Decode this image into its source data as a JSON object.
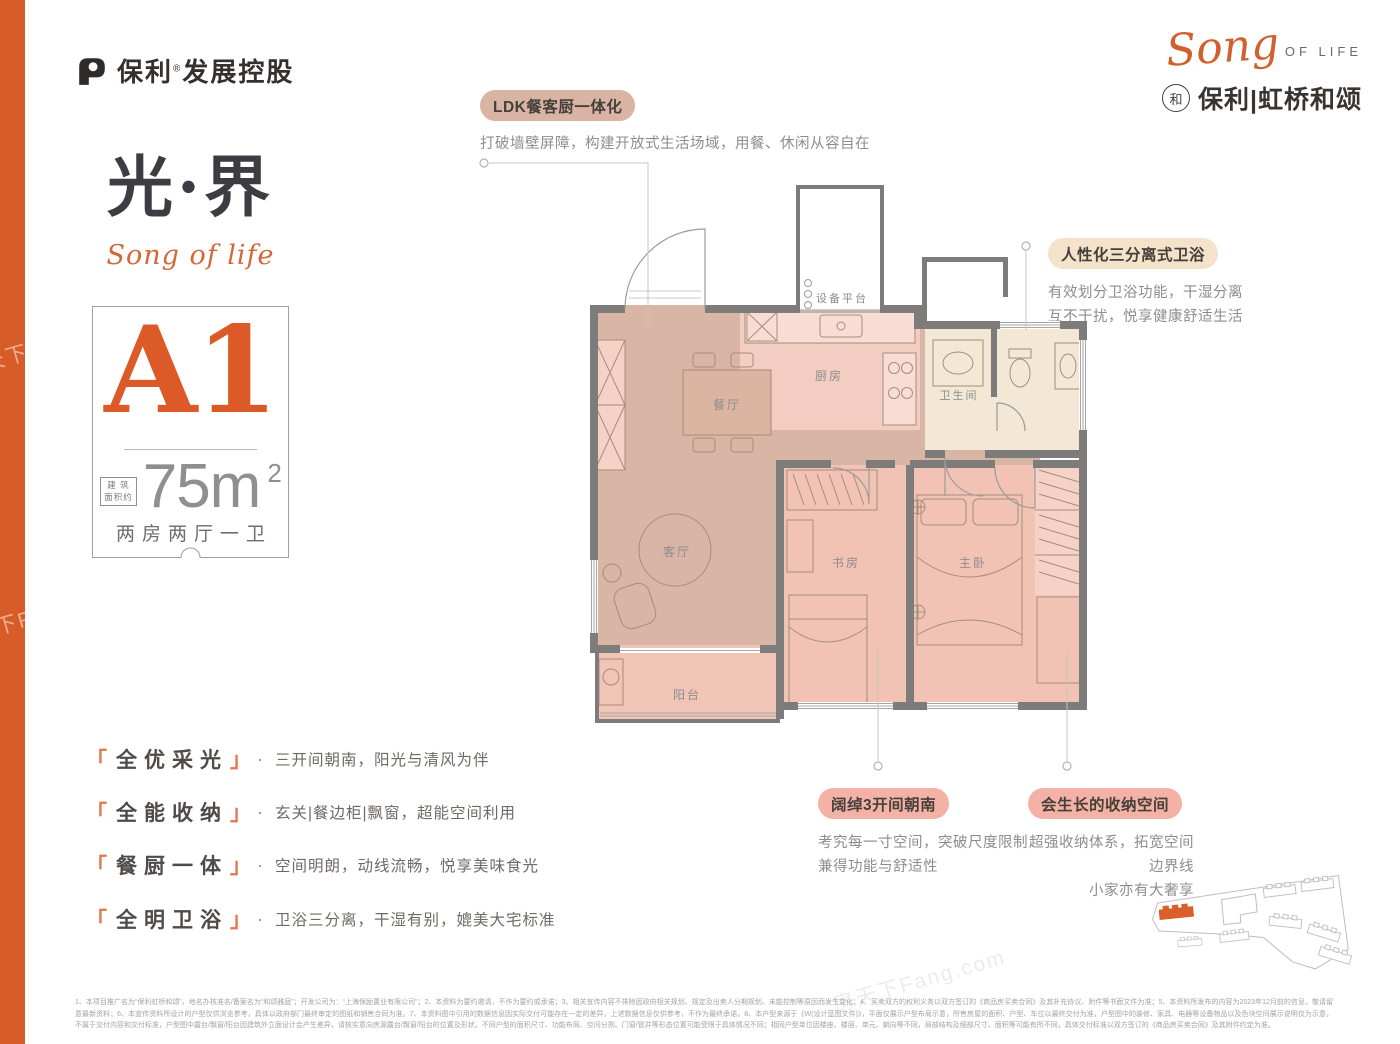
{
  "colors": {
    "accent_orange": "#d85c27",
    "unit_orange": "#dc5a28",
    "pill_ldk_bg": "#d9b4a4",
    "pill_bath_bg": "#f4e2ca",
    "pill_salmon_bg": "#f3b2a5",
    "wall_gray": "#7d7c7a",
    "room_rose": "#d9b5a5",
    "room_salmon": "#f2c3b4",
    "room_kitchen": "#f3ccc2",
    "room_cream": "#f3e8d6"
  },
  "brand": {
    "developer": {
      "name": "保利",
      "reg": "®",
      "suffix": "发展控股"
    },
    "project": {
      "script": "Song",
      "script_suffix": "OF LIFE",
      "badge_char": "和",
      "name": "保利|虹桥和颂"
    }
  },
  "hero": {
    "title": "光·界",
    "script": "Song of life"
  },
  "unit_card": {
    "unit": "A1",
    "area_label_line1": "建 筑",
    "area_label_line2": "面积约",
    "area_number": "75m",
    "area_exponent": "2",
    "layout": "两房两厅一卫"
  },
  "callouts": {
    "ldk": {
      "label": "LDK餐客厨一体化",
      "desc": "打破墙壁屏障，构建开放式生活场域，用餐、休闲从容自在"
    },
    "bath": {
      "label": "人性化三分离式卫浴",
      "desc_line1": "有效划分卫浴功能，干湿分离",
      "desc_line2": "互不干扰，悦享健康舒适生活"
    },
    "bays": {
      "label": "阔绰3开间朝南",
      "desc_line1": "考究每一寸空间，突破尺度限制",
      "desc_line2": "兼得功能与舒适性"
    },
    "storage": {
      "label": "会生长的收纳空间",
      "desc_line1": "超强收纳体系，拓宽空间边界线",
      "desc_line2": "小家亦有大奢享"
    }
  },
  "floorplan": {
    "rooms": {
      "equipment": "设备平台",
      "kitchen": "厨房",
      "dining": "餐厅",
      "living": "客厅",
      "balcony": "阳台",
      "study": "书房",
      "master": "主卧",
      "bathroom": "卫生间"
    }
  },
  "features": [
    {
      "open": "「",
      "title": "全优采光",
      "close": "」",
      "dot": "·",
      "desc": "三开间朝南，阳光与清风为伴"
    },
    {
      "open": "「",
      "title": "全能收纳",
      "close": "」",
      "dot": "·",
      "desc": "玄关|餐边柜|飘窗，超能空间利用"
    },
    {
      "open": "「",
      "title": "餐厨一体",
      "close": "」",
      "dot": "·",
      "desc": "空间明朗，动线流畅，悦享美味食光"
    },
    {
      "open": "「",
      "title": "全明卫浴",
      "close": "」",
      "dot": "·",
      "desc": "卫浴三分离，干湿有别，媲美大宅标准"
    }
  ],
  "watermark": "房天下Fang.com",
  "disclaimer": "1、本项目推广名为“保利虹桥和颂”，地名办核准名/备案名为“和颂雅庭”；开发公司为：“上海保励置业有限公司”；2、本资料为要约邀请，不作为要约或承诺；3、相关宣传内容不排除因政府相关规划、规定及出卖人分期规划、未能控制等原因而发生变化；4、买卖双方的权利义务以双方签订的《商品房买卖合同》及其补充协议、附件等书面文件为准；5、本资料所发布的内容为2023年12月前的信息，敬请留意最新资料；6、本宣传资料所设计的户型仅供浏览参考，具体以政府部门最终审定的图纸和销售合同为准。7、本资料图中引用的数据信息因实际交付可能存在一定的差异，上述数据信息仅供参考，不作为最终承诺。8、本户型来源于《W(设计蓝图文件)》，平面仅展示户型布局示意，所售房屋的面积、户型、车位以最终交付为准，户型图中的装修、家具、电器等设备物品以及色块空间展示说明仅为示意，不属于交付内容和交付标准，户型图中露台/飘窗/阳台因建筑外立面设计会产生差异，请核实意向房源露台/飘窗/阳台的位置及形状。不同户型的面积尺寸、功能布局、空间分割、门窗/管井等形态位置可能受限于具体情况不同；相同户型单位因楼座、楼层、单元、朝向等不同，局部结构及细部尺寸、面积等可能有所不同，具体交付标准以双方签订的《商品房买卖合同》及其附件约定为准。"
}
